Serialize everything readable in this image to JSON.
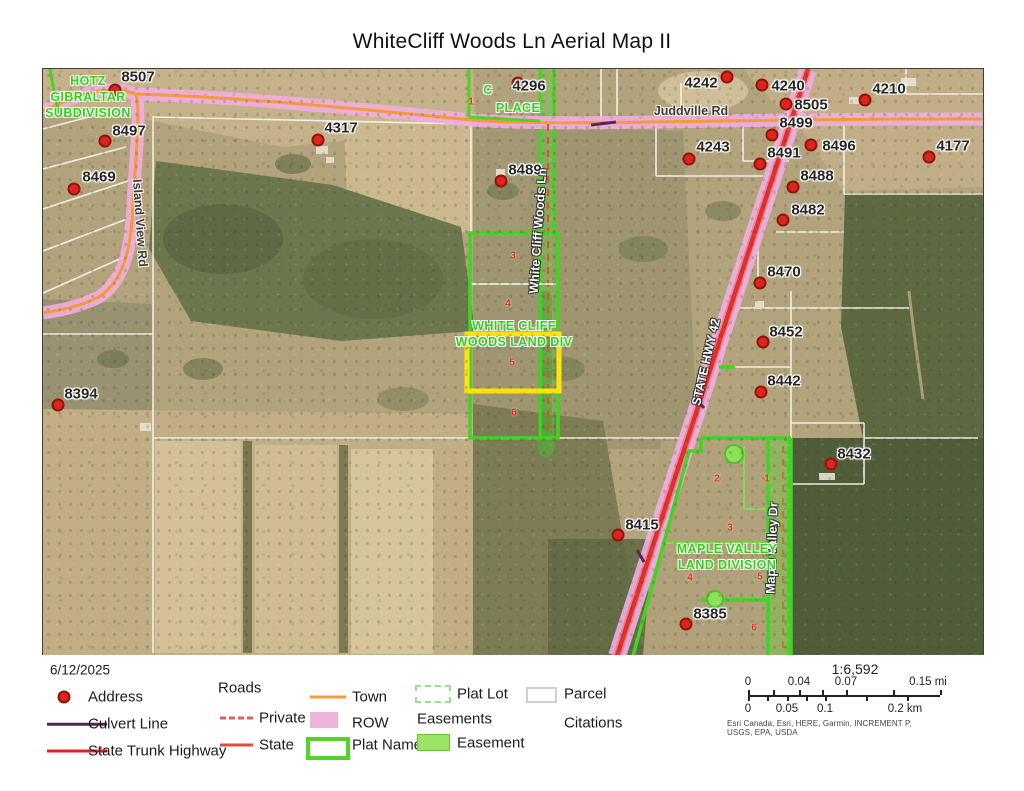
{
  "title": "WhiteCliff Woods Ln Aerial Map II",
  "map": {
    "addresses": [
      {
        "label": "8507",
        "x": 95,
        "y": 8,
        "dot_x": 72,
        "dot_y": 21
      },
      {
        "label": "8497",
        "x": 86,
        "y": 62,
        "dot_x": 62,
        "dot_y": 72
      },
      {
        "label": "8469",
        "x": 56,
        "y": 108,
        "dot_x": 31,
        "dot_y": 120
      },
      {
        "label": "4317",
        "x": 298,
        "y": 59,
        "dot_x": 275,
        "dot_y": 71
      },
      {
        "label": "8394",
        "x": 38,
        "y": 325,
        "dot_x": 15,
        "dot_y": 336
      },
      {
        "label": "4296",
        "x": 486,
        "y": 17,
        "dot_x": 475,
        "dot_y": 14
      },
      {
        "label": "8489",
        "x": 482,
        "y": 101,
        "dot_x": 458,
        "dot_y": 112
      },
      {
        "label": "4242",
        "x": 658,
        "y": 14,
        "dot_x": 684,
        "dot_y": 8
      },
      {
        "label": "4240",
        "x": 745,
        "y": 17,
        "dot_x": 719,
        "dot_y": 16
      },
      {
        "label": "8505",
        "x": 768,
        "y": 36,
        "dot_x": 743,
        "dot_y": 35
      },
      {
        "label": "8499",
        "x": 753,
        "y": 54,
        "dot_x": 729,
        "dot_y": 66
      },
      {
        "label": "4243",
        "x": 670,
        "y": 78,
        "dot_x": 646,
        "dot_y": 90
      },
      {
        "label": "8491",
        "x": 741,
        "y": 84,
        "dot_x": 717,
        "dot_y": 95
      },
      {
        "label": "8496",
        "x": 796,
        "y": 77,
        "dot_x": 768,
        "dot_y": 76
      },
      {
        "label": "4210",
        "x": 846,
        "y": 20,
        "dot_x": 822,
        "dot_y": 31
      },
      {
        "label": "4177",
        "x": 910,
        "y": 77,
        "dot_x": 886,
        "dot_y": 88
      },
      {
        "label": "8488",
        "x": 774,
        "y": 107,
        "dot_x": 750,
        "dot_y": 118
      },
      {
        "label": "8482",
        "x": 765,
        "y": 141,
        "dot_x": 740,
        "dot_y": 151
      },
      {
        "label": "8470",
        "x": 741,
        "y": 203,
        "dot_x": 717,
        "dot_y": 214
      },
      {
        "label": "8452",
        "x": 743,
        "y": 263,
        "dot_x": 720,
        "dot_y": 273
      },
      {
        "label": "8442",
        "x": 741,
        "y": 312,
        "dot_x": 718,
        "dot_y": 323
      },
      {
        "label": "8432",
        "x": 811,
        "y": 385,
        "dot_x": 788,
        "dot_y": 395
      },
      {
        "label": "8415",
        "x": 599,
        "y": 456,
        "dot_x": 575,
        "dot_y": 466
      },
      {
        "label": "8385",
        "x": 667,
        "y": 545,
        "dot_x": 643,
        "dot_y": 555
      }
    ],
    "road_labels": [
      {
        "text": "Juddville Rd",
        "x": 648,
        "y": 42,
        "rotation": 0,
        "style": "dark"
      },
      {
        "text": "Island View Rd",
        "x": 97,
        "y": 154,
        "rotation": 86,
        "style": "dark"
      },
      {
        "text": "White Cliff Woods Ln",
        "x": 495,
        "y": 162,
        "rotation": -86,
        "style": "light"
      },
      {
        "text": "STATE HWY 42",
        "x": 663,
        "y": 293,
        "rotation": -77,
        "style": "light"
      },
      {
        "text": "Maple Valley Dr",
        "x": 729,
        "y": 479,
        "rotation": -88,
        "style": "light"
      }
    ],
    "plat_labels": [
      {
        "lines": [
          "HOTZ",
          "GIBRALTAR",
          "SUBDIVISION"
        ],
        "x": 45,
        "y": 28
      },
      {
        "lines": [
          "C"
        ],
        "x": 445,
        "y": 21
      },
      {
        "lines": [
          "PLACE"
        ],
        "x": 475,
        "y": 39
      },
      {
        "lines": [
          "WHITE CLIFF",
          "WOODS LAND DIV"
        ],
        "x": 471,
        "y": 265
      },
      {
        "lines": [
          "MAPLE VALLEY",
          "LAND DIVISION"
        ],
        "x": 684,
        "y": 488
      }
    ],
    "lot_numbers": [
      {
        "text": "1",
        "x": 428,
        "y": 33
      },
      {
        "text": "3",
        "x": 470,
        "y": 187
      },
      {
        "text": "4",
        "x": 465,
        "y": 235
      },
      {
        "text": "5",
        "x": 469,
        "y": 294
      },
      {
        "text": "6",
        "x": 471,
        "y": 344
      },
      {
        "text": "2",
        "x": 674,
        "y": 410
      },
      {
        "text": "1",
        "x": 724,
        "y": 410
      },
      {
        "text": "3",
        "x": 687,
        "y": 459
      },
      {
        "text": "4",
        "x": 647,
        "y": 509
      },
      {
        "text": "5",
        "x": 717,
        "y": 508
      },
      {
        "text": "6",
        "x": 711,
        "y": 559
      }
    ]
  },
  "legend": {
    "date": "6/12/2025",
    "address_label": "Address",
    "culvert_label": "Culvert Line",
    "sth_label": "State Trunk Highway",
    "roads_header": "Roads",
    "private_label": "Private",
    "state_label": "State",
    "town_label": "Town",
    "row_label": "ROW",
    "plat_name_label": "Plat Name",
    "plat_lot_label": "Plat Lot",
    "easements_header": "Easements",
    "easement_label": "Easement",
    "parcel_label": "Parcel",
    "citations_label": "Citations",
    "scale": {
      "ratio": "1:6,592",
      "mi": [
        "0",
        "0.04",
        "0.07",
        "0.15 mi"
      ],
      "km": [
        "0",
        "0.05",
        "0.1",
        "0.2 km"
      ],
      "attribution": "Esri Canada, Esri, HERE, Garmin, INCREMENT P, USGS, EPA, USDA"
    }
  },
  "colors": {
    "plat_green": "#3fd521",
    "row_pink": "#eeaedd",
    "town_orange": "#f49a3d",
    "highway_red": "#e62e24",
    "private_red": "#e34e35",
    "culvert_purple": "#552b55",
    "address_red": "#e02417",
    "highlight_yellow": "#ffe30a",
    "easement_green": "#8ee05a"
  }
}
